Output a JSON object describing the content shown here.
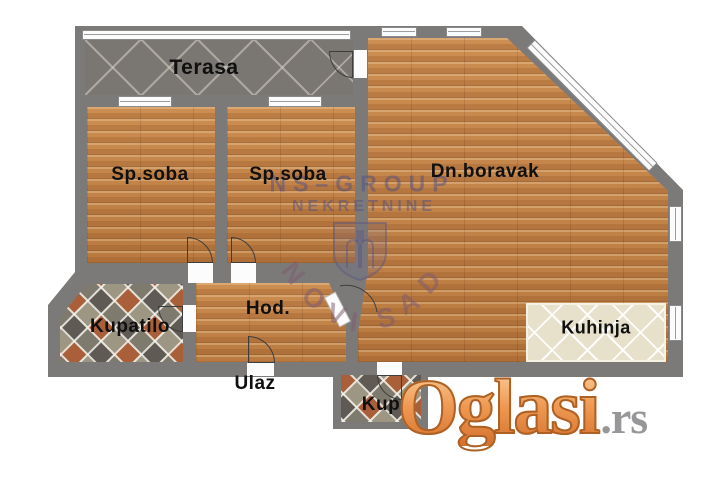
{
  "plan": {
    "labels": {
      "terrace": "Terasa",
      "bedroom1": "Sp.soba",
      "bedroom2": "Sp.soba",
      "living": "Dn.boravak",
      "bathroom": "Kupatilo",
      "hall": "Hod.",
      "entrance": "Ulaz",
      "kitchen": "Kuhinja",
      "wc": "Kup"
    },
    "colors": {
      "wall": "#7c7a78",
      "wood": "#c08448",
      "terrace_tile": "#7a7672",
      "kitchen_tile": "#e7e0cb",
      "label_text": "#101010"
    }
  },
  "watermark": {
    "line1": "NS–GROUP",
    "line2": "NEKRETNINE",
    "city": "NOVI SAD",
    "city_letters": [
      "N",
      "O",
      "V",
      "I",
      "S",
      "A",
      "D"
    ],
    "color": "#50508480"
  },
  "logo": {
    "name": "Oglasi",
    "tld": ".rs",
    "orange": "#ef9a54",
    "gray": "#97979a"
  }
}
